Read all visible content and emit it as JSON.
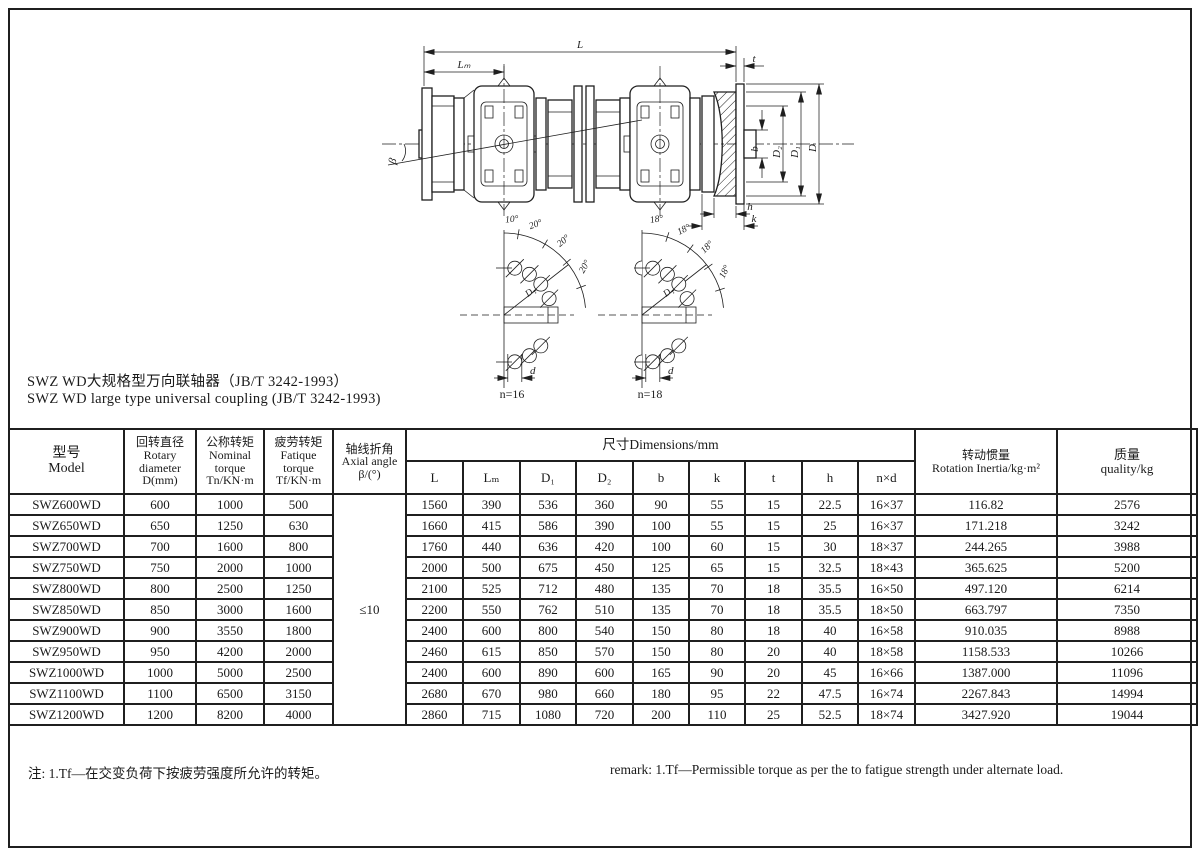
{
  "page": {
    "title_zh": "SWZ WD大规格型万向联轴器（JB/T 3242-1993）",
    "title_en": "SWZ WD large type universal coupling (JB/T 3242-1993)",
    "note_zh": "注: 1.Tf—在交变负荷下按疲劳强度所允许的转矩。",
    "note_en": "remark: 1.Tf—Permissible torque as per the to fatigue strength under alternate load."
  },
  "drawing": {
    "labels": {
      "L": "L",
      "Lm": "Lₘ",
      "t": "t",
      "b": "b",
      "D2": "D₂",
      "D1": "D₁",
      "D": "D",
      "h": "h",
      "k": "k",
      "beta": "β"
    },
    "sector_left": {
      "angles": [
        "10°",
        "20°",
        "20°",
        "20°"
      ],
      "d1": "D₁",
      "d": "d",
      "n_label": "n=16"
    },
    "sector_right": {
      "angles": [
        "18°",
        "18°",
        "18°",
        "18°"
      ],
      "d1": "D₁",
      "d": "d",
      "n_label": "n=18"
    }
  },
  "table": {
    "headers": {
      "model": [
        "型号",
        "Model"
      ],
      "rotary": [
        "回转直径",
        "Rotary",
        "diameter",
        "D(mm)"
      ],
      "nominal": [
        "公称转矩",
        "Nominal",
        "torque",
        "Tn/KN·m"
      ],
      "fatigue": [
        "疲劳转矩",
        "Fatique",
        "torque",
        "Tf/KN·m"
      ],
      "axial": [
        "轴线折角",
        "Axial angle",
        "β/(°)"
      ],
      "dims_title": "尺寸Dimensions/mm",
      "dim_cols": [
        "L",
        "Lₘ",
        "D₁",
        "D₂",
        "b",
        "k",
        "t",
        "h",
        "n×d"
      ],
      "inertia": [
        "转动惯量",
        "Rotation Inertia/kg·m²"
      ],
      "quality": [
        "质量",
        "quality/kg"
      ]
    },
    "axial_angle_value": "≤10",
    "rows": [
      [
        "SWZ600WD",
        "600",
        "1000",
        "500",
        "1560",
        "390",
        "536",
        "360",
        "90",
        "55",
        "15",
        "22.5",
        "16×37",
        "116.82",
        "2576"
      ],
      [
        "SWZ650WD",
        "650",
        "1250",
        "630",
        "1660",
        "415",
        "586",
        "390",
        "100",
        "55",
        "15",
        "25",
        "16×37",
        "171.218",
        "3242"
      ],
      [
        "SWZ700WD",
        "700",
        "1600",
        "800",
        "1760",
        "440",
        "636",
        "420",
        "100",
        "60",
        "15",
        "30",
        "18×37",
        "244.265",
        "3988"
      ],
      [
        "SWZ750WD",
        "750",
        "2000",
        "1000",
        "2000",
        "500",
        "675",
        "450",
        "125",
        "65",
        "15",
        "32.5",
        "18×43",
        "365.625",
        "5200"
      ],
      [
        "SWZ800WD",
        "800",
        "2500",
        "1250",
        "2100",
        "525",
        "712",
        "480",
        "135",
        "70",
        "18",
        "35.5",
        "16×50",
        "497.120",
        "6214"
      ],
      [
        "SWZ850WD",
        "850",
        "3000",
        "1600",
        "2200",
        "550",
        "762",
        "510",
        "135",
        "70",
        "18",
        "35.5",
        "18×50",
        "663.797",
        "7350"
      ],
      [
        "SWZ900WD",
        "900",
        "3550",
        "1800",
        "2400",
        "600",
        "800",
        "540",
        "150",
        "80",
        "18",
        "40",
        "16×58",
        "910.035",
        "8988"
      ],
      [
        "SWZ950WD",
        "950",
        "4200",
        "2000",
        "2460",
        "615",
        "850",
        "570",
        "150",
        "80",
        "20",
        "40",
        "18×58",
        "1158.533",
        "10266"
      ],
      [
        "SWZ1000WD",
        "1000",
        "5000",
        "2500",
        "2400",
        "600",
        "890",
        "600",
        "165",
        "90",
        "20",
        "45",
        "16×66",
        "1387.000",
        "11096"
      ],
      [
        "SWZ1100WD",
        "1100",
        "6500",
        "3150",
        "2680",
        "670",
        "980",
        "660",
        "180",
        "95",
        "22",
        "47.5",
        "16×74",
        "2267.843",
        "14994"
      ],
      [
        "SWZ1200WD",
        "1200",
        "8200",
        "4000",
        "2860",
        "715",
        "1080",
        "720",
        "200",
        "110",
        "25",
        "52.5",
        "18×74",
        "3427.920",
        "19044"
      ]
    ]
  }
}
